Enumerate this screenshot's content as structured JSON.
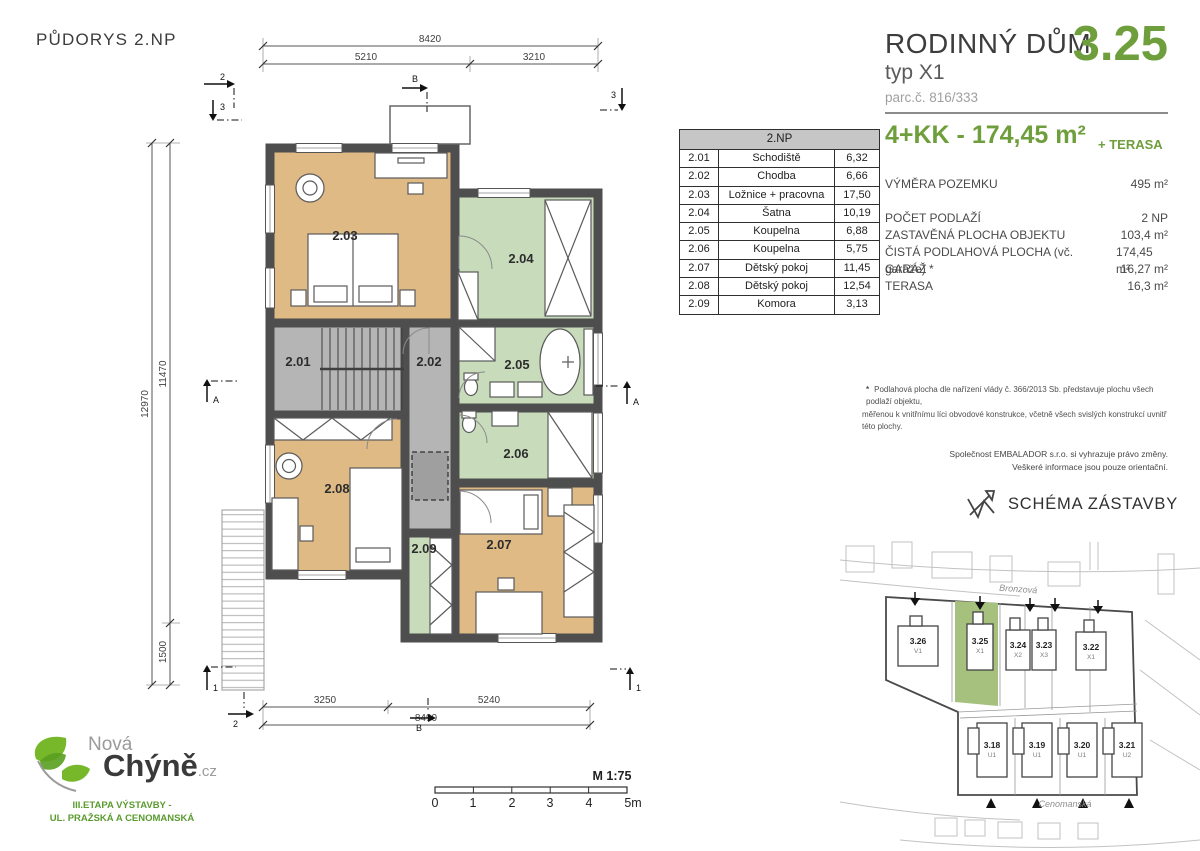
{
  "colors": {
    "accent_green": "#6f9e3c",
    "room_tan": "#dfba85",
    "room_green": "#c8dcbc",
    "room_gray": "#b5b5b5",
    "wall_gray": "#4e4e4e",
    "plot_green": "#a6c17d"
  },
  "plan": {
    "title": "PŮDORYS 2.NP",
    "room_labels": [
      "2.01",
      "2.02",
      "2.03",
      "2.04",
      "2.05",
      "2.06",
      "2.07",
      "2.08",
      "2.09"
    ],
    "dims": {
      "top_total": "8420",
      "top_left": "5210",
      "top_right": "3210",
      "left_total": "12970",
      "left_upper": "11470",
      "left_lower": "1500",
      "bottom_left": "3250",
      "bottom_right": "5240",
      "bottom_total": "8490"
    },
    "markers": {
      "m1": "1",
      "m2": "2",
      "m3": "3",
      "mA": "A",
      "mB": "B"
    }
  },
  "room_table": {
    "header": "2.NP",
    "rows": [
      {
        "id": "2.01",
        "name": "Schodiště",
        "area": "6,32"
      },
      {
        "id": "2.02",
        "name": "Chodba",
        "area": "6,66"
      },
      {
        "id": "2.03",
        "name": "Ložnice + pracovna",
        "area": "17,50"
      },
      {
        "id": "2.04",
        "name": "Šatna",
        "area": "10,19"
      },
      {
        "id": "2.05",
        "name": "Koupelna",
        "area": "6,88"
      },
      {
        "id": "2.06",
        "name": "Koupelna",
        "area": "5,75"
      },
      {
        "id": "2.07",
        "name": "Dětský pokoj",
        "area": "11,45"
      },
      {
        "id": "2.08",
        "name": "Dětský pokoj",
        "area": "12,54"
      },
      {
        "id": "2.09",
        "name": "Komora",
        "area": "3,13"
      }
    ]
  },
  "header": {
    "title": "RODINNÝ DŮM",
    "type": "typ X1",
    "parcel": "parc.č. 816/333",
    "unit_number": "3.25",
    "disposition": "4+KK - 174,45 m²",
    "terrace": "+ TERASA"
  },
  "specs": [
    {
      "label": "VÝMĚRA POZEMKU",
      "value": "495 m²"
    },
    {
      "label": "POČET PODLAŽÍ",
      "value": "2 NP"
    },
    {
      "label": "ZASTAVĚNÁ PLOCHA OBJEKTU",
      "value": "103,4 m²"
    },
    {
      "label": "ČISTÁ PODLAHOVÁ PLOCHA (vč. garáže) *",
      "value": "174,45 m²"
    },
    {
      "label": "GARÁŽ",
      "value": "16,27 m²"
    },
    {
      "label": "TERASA",
      "value": "16,3 m²"
    }
  ],
  "notes": {
    "asterisk": "*",
    "footnote_line1": "Podlahová plocha dle nařízení vlády č. 366/2013 Sb. představuje plochu všech podlaží objektu,",
    "footnote_line2": "měřenou k vnitřnímu líci obvodové konstrukce, včetně všech svislých konstrukcí uvnitř této plochy.",
    "company_line1": "Společnost EMBALADOR s.r.o. si vyhrazuje právo změny.",
    "company_line2": "Veškeré informace jsou pouze orientační."
  },
  "schema": {
    "title": "SCHÉMA ZÁSTAVBY",
    "street_top": "Bronzová",
    "street_bottom": "Cenomanská",
    "plots_upper": [
      {
        "id": "3.26",
        "type": "V1"
      },
      {
        "id": "3.25",
        "type": "X1"
      },
      {
        "id": "3.24",
        "type": "X2"
      },
      {
        "id": "3.23",
        "type": "X3"
      },
      {
        "id": "3.22",
        "type": "X1"
      }
    ],
    "plots_lower": [
      {
        "id": "3.18",
        "type": "U1"
      },
      {
        "id": "3.19",
        "type": "U1"
      },
      {
        "id": "3.20",
        "type": "U1"
      },
      {
        "id": "3.21",
        "type": "U2"
      }
    ]
  },
  "logo": {
    "brand_top": "Nová",
    "brand_main": "Chýně",
    "brand_tld": ".cz",
    "tagline_line1": "III.ETAPA VÝSTAVBY -",
    "tagline_line2": "UL. PRAŽSKÁ A CENOMANSKÁ"
  },
  "scale_bar": {
    "label": "M 1:75",
    "ticks": [
      "0",
      "1",
      "2",
      "3",
      "4",
      "5m"
    ]
  }
}
